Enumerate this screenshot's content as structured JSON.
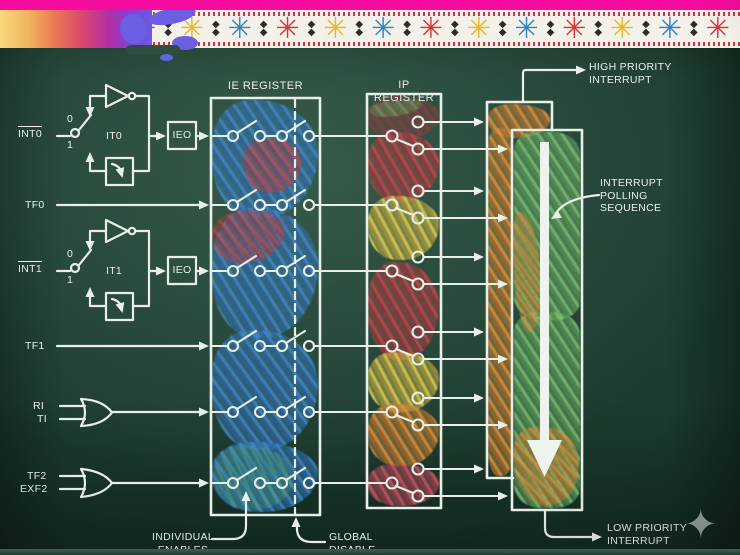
{
  "signals": {
    "int0": "INT0",
    "tf0": "TF0",
    "int1": "INT1",
    "tf1": "TF1",
    "ri": "RI",
    "ti": "TI",
    "tf2": "TF2",
    "exf2": "EXF2"
  },
  "switch_labels": {
    "it0_pos0": "0",
    "it0_pos1": "1",
    "it1_pos0": "0",
    "it1_pos1": "1"
  },
  "blocks": {
    "it0": "IT0",
    "it1": "IT1",
    "ieo0": "IEO",
    "ieo1": "IEO"
  },
  "registers": {
    "ie": "IE REGISTER",
    "ip": "IP REGISTER"
  },
  "annotations": {
    "high_priority": "HIGH PRIORITY\nINTERRUPT",
    "polling": "INTERRUPT\nPOLLING\nSEQUENCE",
    "low_priority": "LOW PRIORITY\nINTERRUPT",
    "individual_enables": "INDIVIDUAL\nENABLES",
    "global_disable": "GLOBAL\nDISABLE"
  },
  "decor": {
    "star_glyph": "✳",
    "diamond_glyph": "◆\n◆",
    "corner_diamond_glyph": "◆",
    "sparkle_glyph": "✦",
    "star_colors": [
      "#d8333c",
      "#e9b821",
      "#2f84c6"
    ],
    "star_count": 13
  },
  "colors": {
    "top_bar_magenta": "#f60c9e",
    "chalk_white": "#e8efe8",
    "chalk_blue": "#3f85c6",
    "chalk_red": "#c04a4e",
    "chalk_yellow": "#e2cd52",
    "chalk_orange": "#dd9140",
    "chalk_green": "#7cbf72",
    "board_green": "#1d3c30"
  }
}
